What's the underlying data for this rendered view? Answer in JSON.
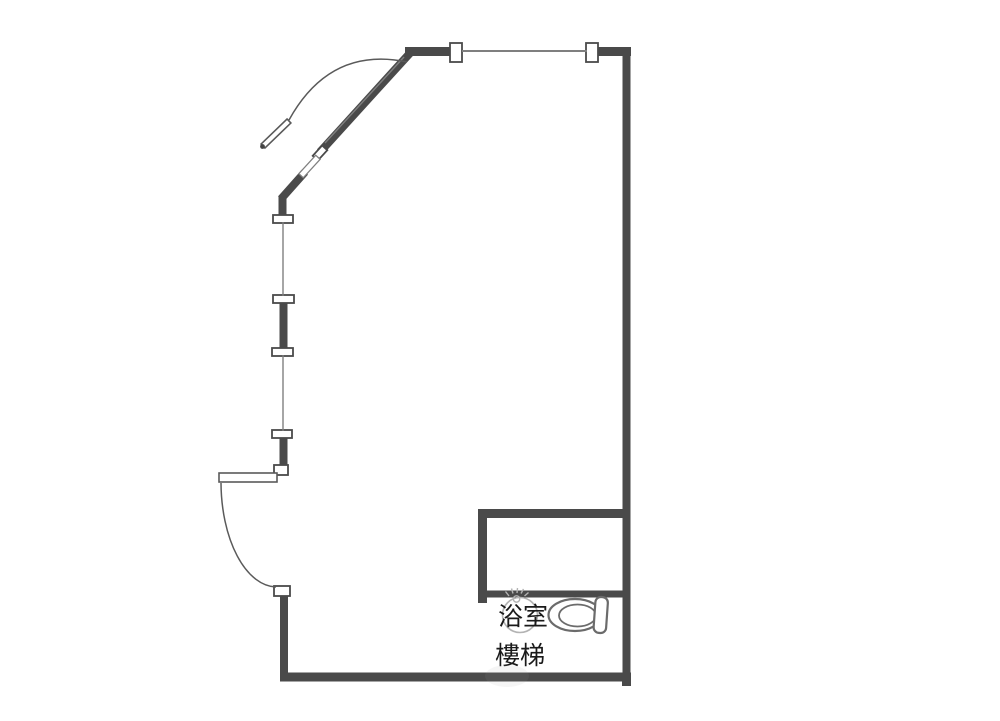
{
  "floor_plan": {
    "labels": {
      "bathroom": "浴室",
      "stairs": "樓梯"
    },
    "colors": {
      "wall": "#4a4a4a",
      "thin_line": "#7f7f7f",
      "door_line": "#5a5a5a",
      "fixture_outline": "#6b6b6b",
      "shower": "#b3b3b3",
      "text": "#1a1a1a",
      "background": "#ffffff"
    },
    "icons": {
      "toilet": "toilet-icon",
      "shower": "shower-head-icon"
    }
  }
}
